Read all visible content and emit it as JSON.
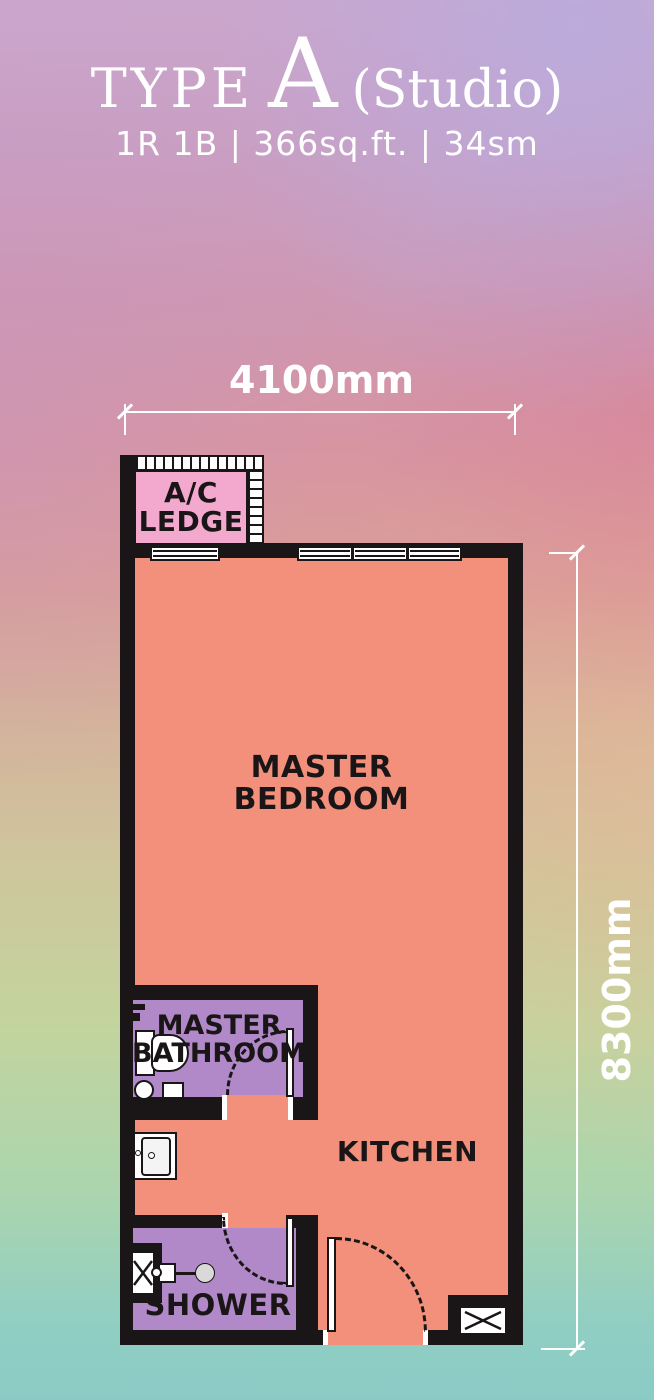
{
  "header": {
    "type_label": "TYPE",
    "type_letter": "A",
    "type_suffix": "(Studio)",
    "specs": "1R 1B | 366sq.ft. | 34sm"
  },
  "dimensions": {
    "width": "4100mm",
    "height": "8300mm"
  },
  "rooms": {
    "ac_ledge": {
      "line1": "A/C",
      "line2": "LEDGE"
    },
    "master_bedroom": {
      "line1": "MASTER",
      "line2": "BEDROOM"
    },
    "master_bathroom": {
      "line1": "MASTER",
      "line2": "BATHROOM"
    },
    "kitchen": {
      "label": "KITCHEN"
    },
    "shower": {
      "label": "SHOWER"
    }
  },
  "colors": {
    "floor_salmon": "#F2907B",
    "room_purple": "#B189C9",
    "ledge_pink": "#F3A8CE",
    "wall_black": "#1A1617",
    "text_white": "#FFFFFF"
  }
}
